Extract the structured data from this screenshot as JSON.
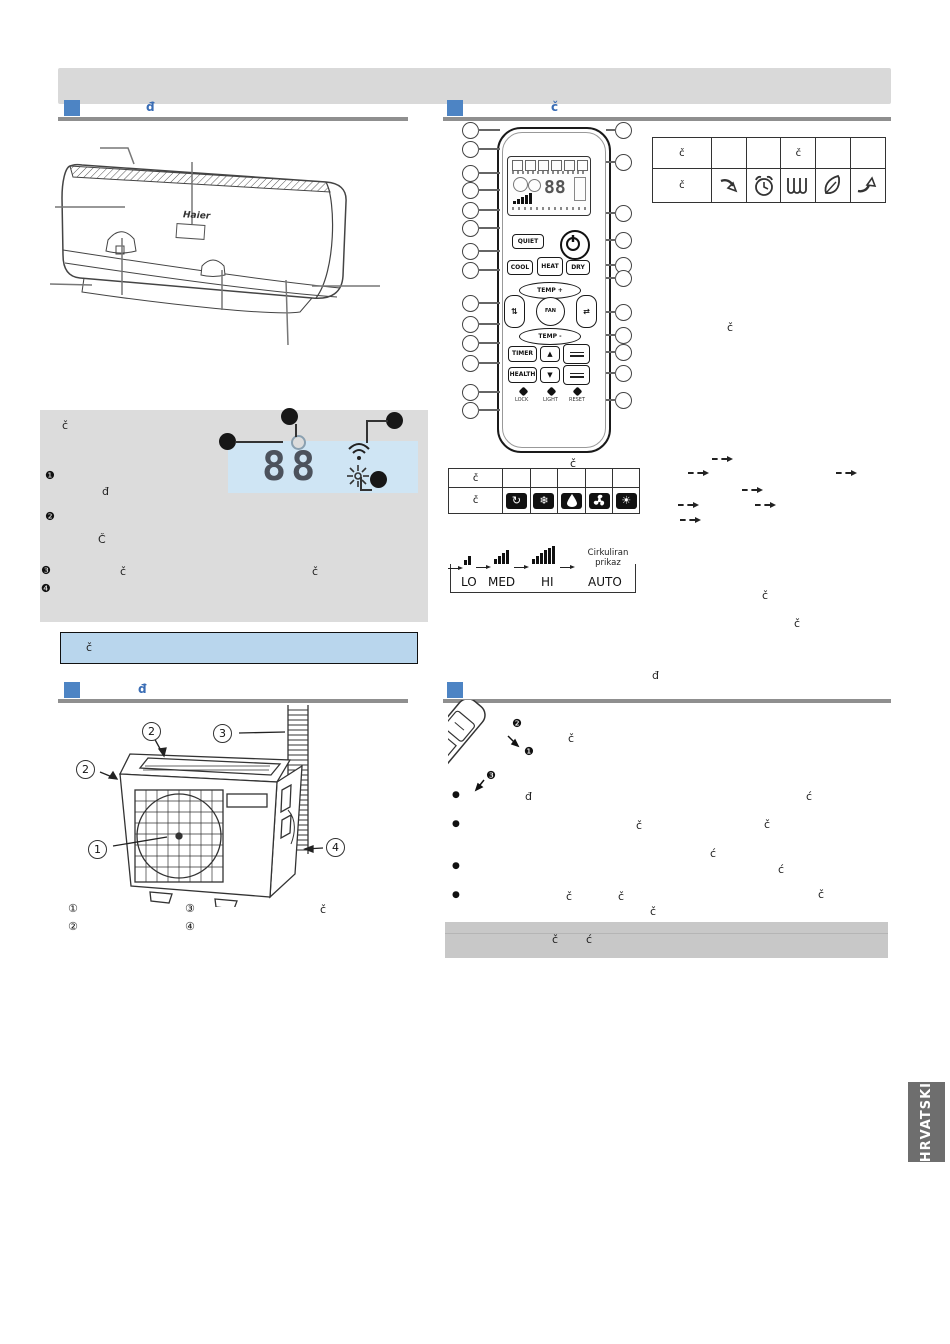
{
  "header": {
    "banner_text": "",
    "sec_indoor_marker": "đ",
    "sec_remote_marker": "č",
    "sec_outdoor_marker": "đ",
    "sec_battery_marker": ""
  },
  "indoor_unit": {
    "brand": "Haier"
  },
  "display_panel": {
    "title_char": "č",
    "b1": "❶",
    "b2": "❷",
    "b3": "❸",
    "b4": "❹",
    "char_line2": "đ",
    "char_line3": "Č",
    "char_b3_a": "č",
    "char_b3_b": "č",
    "digits": "88"
  },
  "blue_banner": {
    "char": "č"
  },
  "remote": {
    "caption_char": "č",
    "buttons": {
      "quiet": "QUIET",
      "cool": "COOL",
      "heat": "HEAT",
      "dry": "DRY",
      "temp_up": "TEMP +",
      "temp_down": "TEMP -",
      "fan": "FAN",
      "timer": "TIMER",
      "health": "HEALTH",
      "arrow_up": "▲",
      "arrow_down": "▼",
      "lock": "LOCK",
      "light": "LIGHT",
      "reset": "RESET"
    }
  },
  "mode_table": {
    "r1c1": "č",
    "r2c1": "č",
    "icons": [
      {
        "name": "auto-mode-icon",
        "glyph": "↻"
      },
      {
        "name": "cool-mode-icon",
        "glyph": "❄"
      },
      {
        "name": "dry-mode-icon",
        "glyph": ""
      },
      {
        "name": "fan-mode-icon",
        "glyph": ""
      },
      {
        "name": "heat-mode-icon",
        "glyph": "☀"
      }
    ]
  },
  "airflow_table": {
    "r1c1": "č",
    "r1c4": "č",
    "r2c1": "č",
    "icons": [
      "swing-down-arrow-icon",
      "timer-clock-icon",
      "heater-coil-icon",
      "health-leaf-icon",
      "swing-up-arrow-icon"
    ]
  },
  "fan_diagram": {
    "labels": [
      "LO",
      "MED",
      "HI",
      "AUTO"
    ],
    "auto_caption_line1": "Cirkuliran",
    "auto_caption_line2": "prikaz"
  },
  "scattered": {
    "right_of_remote": "č",
    "below_fan_a": "č",
    "below_fan_b": "č",
    "above_outdoor": "đ"
  },
  "outdoor_unit": {
    "callout_top": "2",
    "callout_pipe": "3",
    "callout_left": "2",
    "callout_fan": "1",
    "callout_bottom": "4",
    "legend": {
      "i1": "①",
      "i2": "②",
      "i3": "③",
      "i4": "④",
      "char": "č"
    }
  },
  "battery_section": {
    "step1": "❶",
    "step2": "❷",
    "step3": "❸",
    "caption_char": "č",
    "bullet": "●",
    "l1a": "đ",
    "l1b": "ć",
    "l2a": "č",
    "l2b": "č",
    "l2c": "ć",
    "l3a": "ć",
    "l4a": "č",
    "l4b": "č",
    "l4c": "č",
    "l5a": "č"
  },
  "note_banner": {
    "a": "č",
    "b": "ć"
  },
  "language_tab": {
    "label": "HRVATSKI"
  }
}
